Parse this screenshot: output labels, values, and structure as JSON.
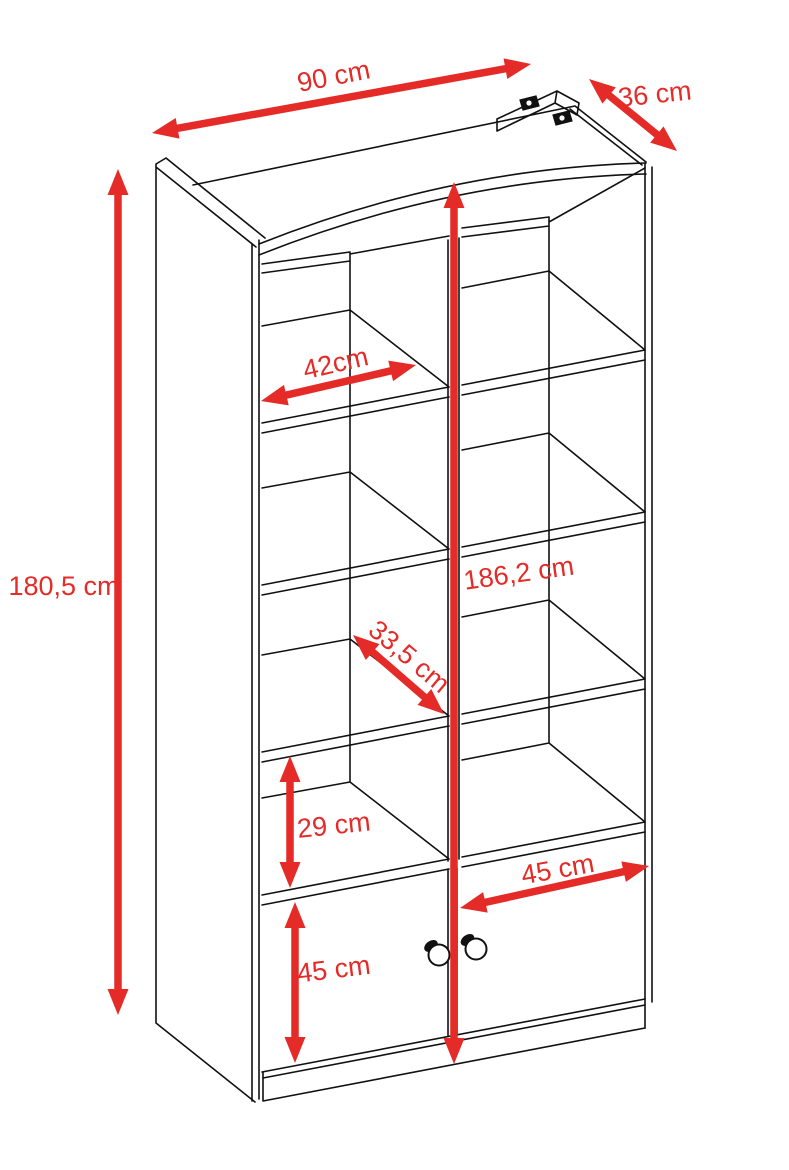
{
  "title": "Bookcase technical dimension drawing",
  "colors": {
    "dimension": "#e42b27",
    "line": "#111111",
    "background": "#ffffff"
  },
  "dimensions": [
    {
      "id": "width-top",
      "label": "90 cm",
      "x1": 152,
      "y1": 133,
      "x2": 531,
      "y2": 64,
      "label_x": 334,
      "label_y": 78,
      "label_rotate": -11
    },
    {
      "id": "depth-top",
      "label": "36 cm",
      "x1": 589,
      "y1": 79,
      "x2": 677,
      "y2": 151,
      "label_x": 655,
      "label_y": 96,
      "label_rotate": -6
    },
    {
      "id": "height-left",
      "label": "180,5 cm",
      "x1": 118,
      "y1": 169,
      "x2": 118,
      "y2": 1015,
      "label_x": 64,
      "label_y": 588,
      "label_rotate": 0
    },
    {
      "id": "height-center",
      "label": "186,2 cm",
      "x1": 454,
      "y1": 182,
      "x2": 454,
      "y2": 1064,
      "label_x": 519,
      "label_y": 575,
      "label_rotate": -8
    },
    {
      "id": "shelf-width",
      "label": "42cm",
      "x1": 261,
      "y1": 401,
      "x2": 416,
      "y2": 365,
      "label_x": 336,
      "label_y": 365,
      "label_rotate": -13
    },
    {
      "id": "shelf-depth",
      "label": "33,5 cm",
      "x1": 353,
      "y1": 635,
      "x2": 444,
      "y2": 714,
      "label_x": 408,
      "label_y": 658,
      "label_rotate": 40
    },
    {
      "id": "compartment-height",
      "label": "29 cm",
      "x1": 290,
      "y1": 756,
      "x2": 290,
      "y2": 888,
      "label_x": 334,
      "label_y": 827,
      "label_rotate": -6
    },
    {
      "id": "door-width",
      "label": "45 cm",
      "x1": 460,
      "y1": 908,
      "x2": 649,
      "y2": 866,
      "label_x": 558,
      "label_y": 871,
      "label_rotate": -10
    },
    {
      "id": "door-height",
      "label": "45 cm",
      "x1": 295,
      "y1": 902,
      "x2": 295,
      "y2": 1063,
      "label_x": 334,
      "label_y": 971,
      "label_rotate": -7
    }
  ]
}
